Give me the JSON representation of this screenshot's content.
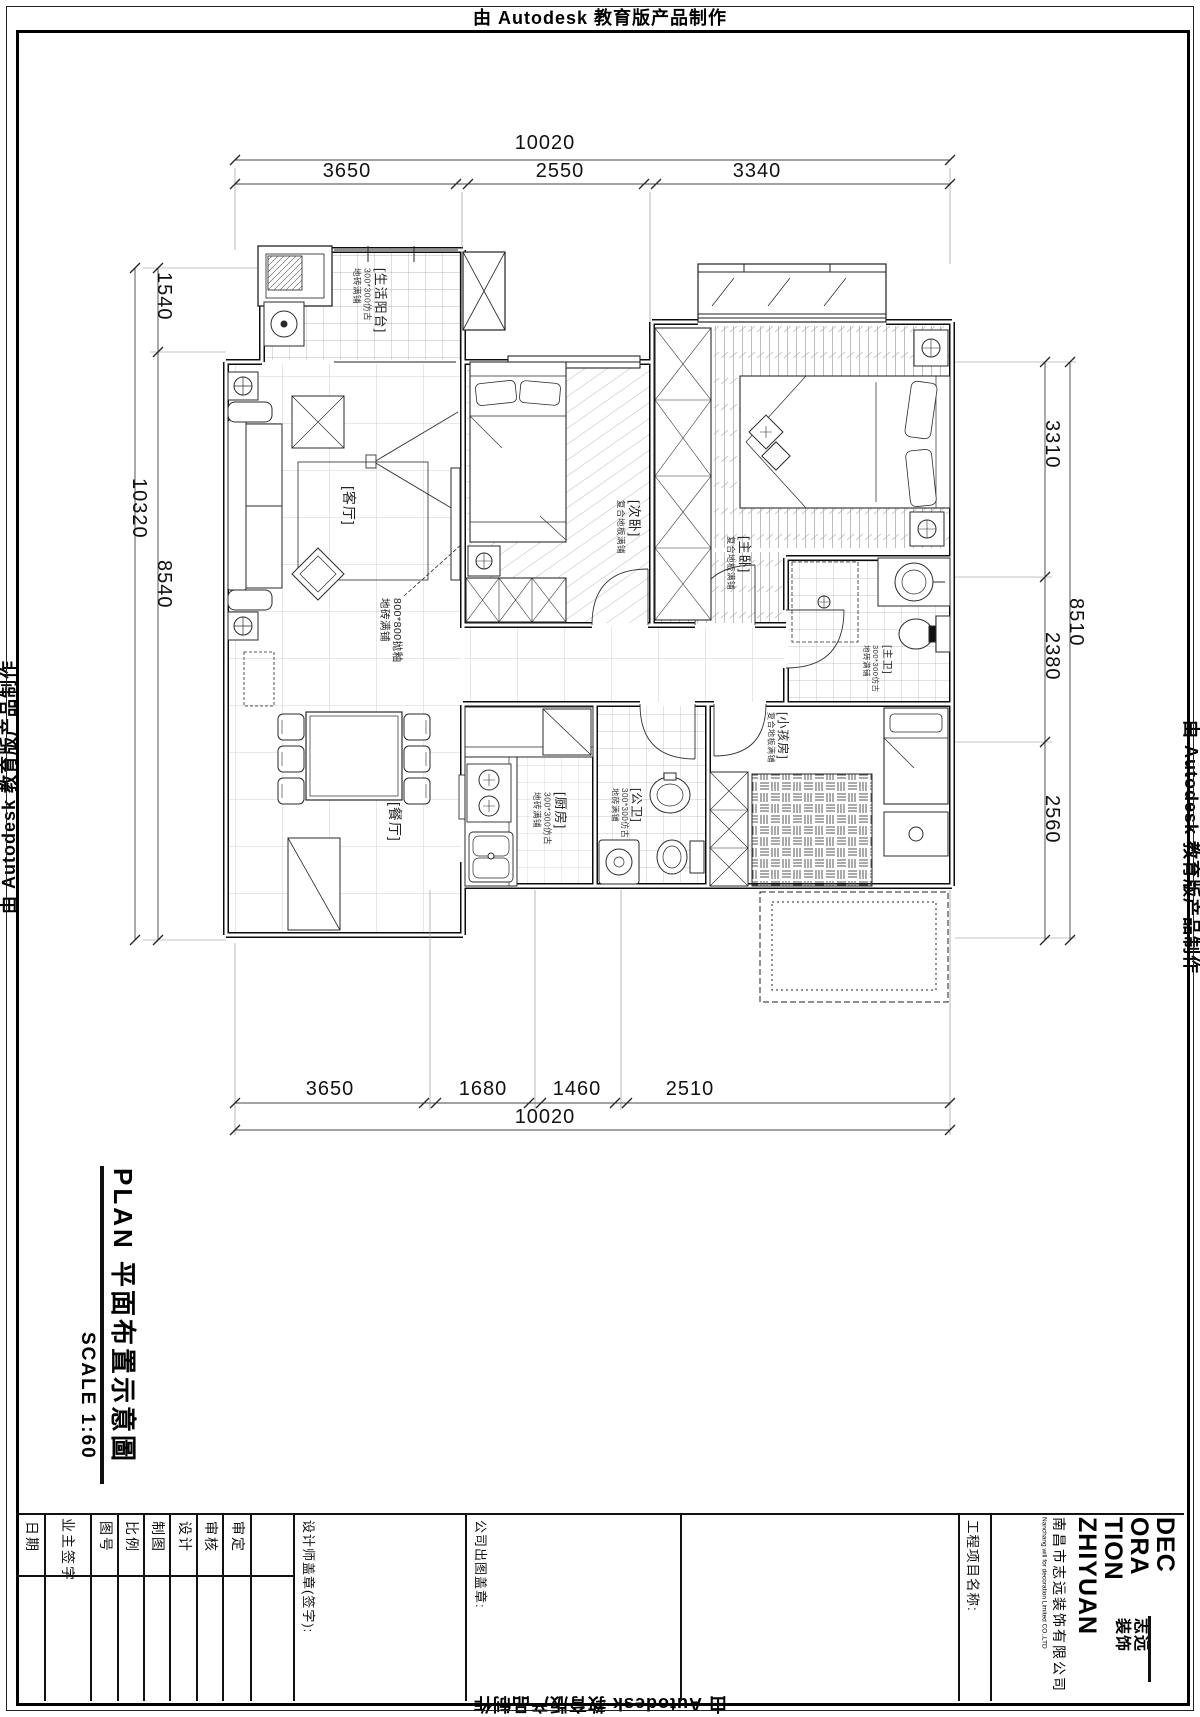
{
  "stamps": {
    "edge_text": "由 Autodesk 教育版产品制作"
  },
  "dimensions": {
    "top": {
      "total": "10020",
      "segments": [
        "3650",
        "2550",
        "3340"
      ]
    },
    "bottom": {
      "total": "10020",
      "segments": [
        "3650",
        "1680",
        "1460",
        "2510"
      ]
    },
    "left": {
      "outer_total": "10320",
      "segments": [
        "1540",
        "8540"
      ]
    },
    "right": {
      "outer_total": "8510",
      "segments": [
        "3310",
        "2380",
        "2560"
      ]
    }
  },
  "plan": {
    "rooms": [
      {
        "name": "[生活阳台]",
        "notes": [
          "300*300仿古",
          "地砖满铺"
        ]
      },
      {
        "name": "[客厅]",
        "notes": []
      },
      {
        "name": "[次卧]",
        "notes": [
          "复合地板满铺"
        ]
      },
      {
        "name": "[主卧]",
        "notes": [
          "复合地板满铺"
        ]
      },
      {
        "name": "[主卫]",
        "notes": [
          "300*300仿古",
          "地砖满铺"
        ]
      },
      {
        "name": "[小孩房]",
        "notes": [
          "复合地板满铺"
        ]
      },
      {
        "name": "[厨房]",
        "notes": [
          "300*300仿古",
          "地砖满铺"
        ]
      },
      {
        "name": "[公卫]",
        "notes": [
          "300*300仿古",
          "地砖满铺"
        ]
      },
      {
        "name": "[餐厅]",
        "notes": []
      }
    ],
    "floor_note": [
      "800*800抛釉",
      "地砖满铺"
    ]
  },
  "title_block": {
    "title": "PLAN  平面布置示意圖",
    "scale": "SCALE  1:60",
    "fields": [
      "审定",
      "审核",
      "设计",
      "制图",
      "比例",
      "图号",
      "业主签字",
      "日期"
    ],
    "designer_stamp": "设计师盖章(签字):",
    "company_stamp": "公司出图盖章:",
    "project_label": "工程项目名称:",
    "logo": {
      "words": [
        "DEC",
        "ORA",
        "TION",
        "ZHIYUAN"
      ],
      "seal": [
        "志远",
        "装饰"
      ],
      "company_cn": "南昌市志远装饰有限公司",
      "company_en": "Nanchang will for decoration Limited CO.,LTD"
    }
  }
}
